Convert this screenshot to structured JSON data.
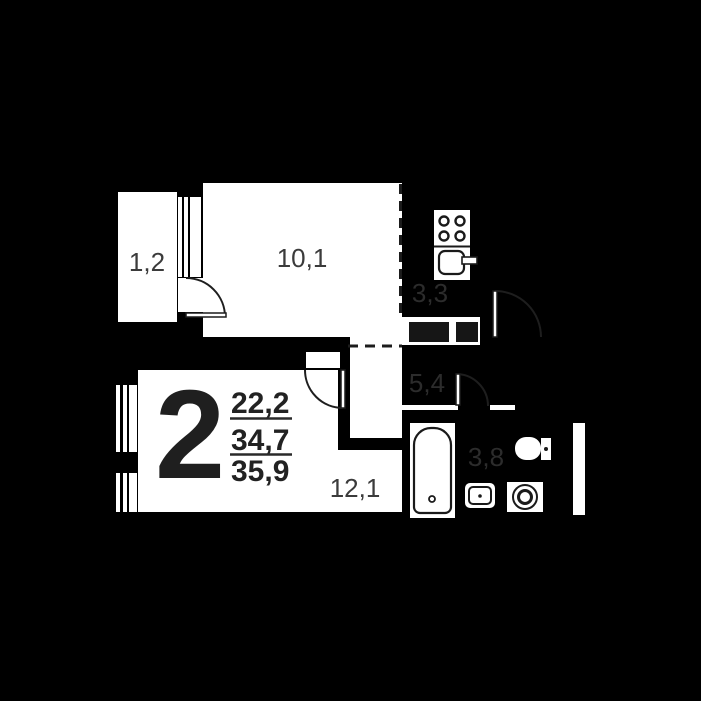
{
  "plan": {
    "title": "2-room apartment floor plan",
    "unit": {
      "rooms_count": "2",
      "living_area": "22,2",
      "area_without_balcony": "34,7",
      "total_area": "35,9"
    },
    "rooms": {
      "balcony": {
        "name": "balcony",
        "area": "1,2"
      },
      "bedroom": {
        "name": "bedroom",
        "area": "10,1"
      },
      "kitchen": {
        "name": "kitchen-niche",
        "area": "3,3"
      },
      "hall": {
        "name": "hallway",
        "area": "5,4"
      },
      "bathroom": {
        "name": "bathroom",
        "area": "3,8"
      },
      "living": {
        "name": "living-room",
        "area": "12,1"
      }
    },
    "icons": [
      "stove-icon",
      "kitchen-sink-icon",
      "bathtub-icon",
      "washbasin-icon",
      "washing-machine-icon",
      "toilet-icon",
      "window-icon",
      "door-arc-icon",
      "vent-shaft-icon"
    ],
    "colors": {
      "background": "#000000",
      "room_fill": "#ffffff",
      "linework": "#1c1c1c",
      "label_on_white": "#3b3b3b",
      "label_on_dark": "#2c2c2c",
      "unit_number": "#1f1f1f"
    }
  }
}
